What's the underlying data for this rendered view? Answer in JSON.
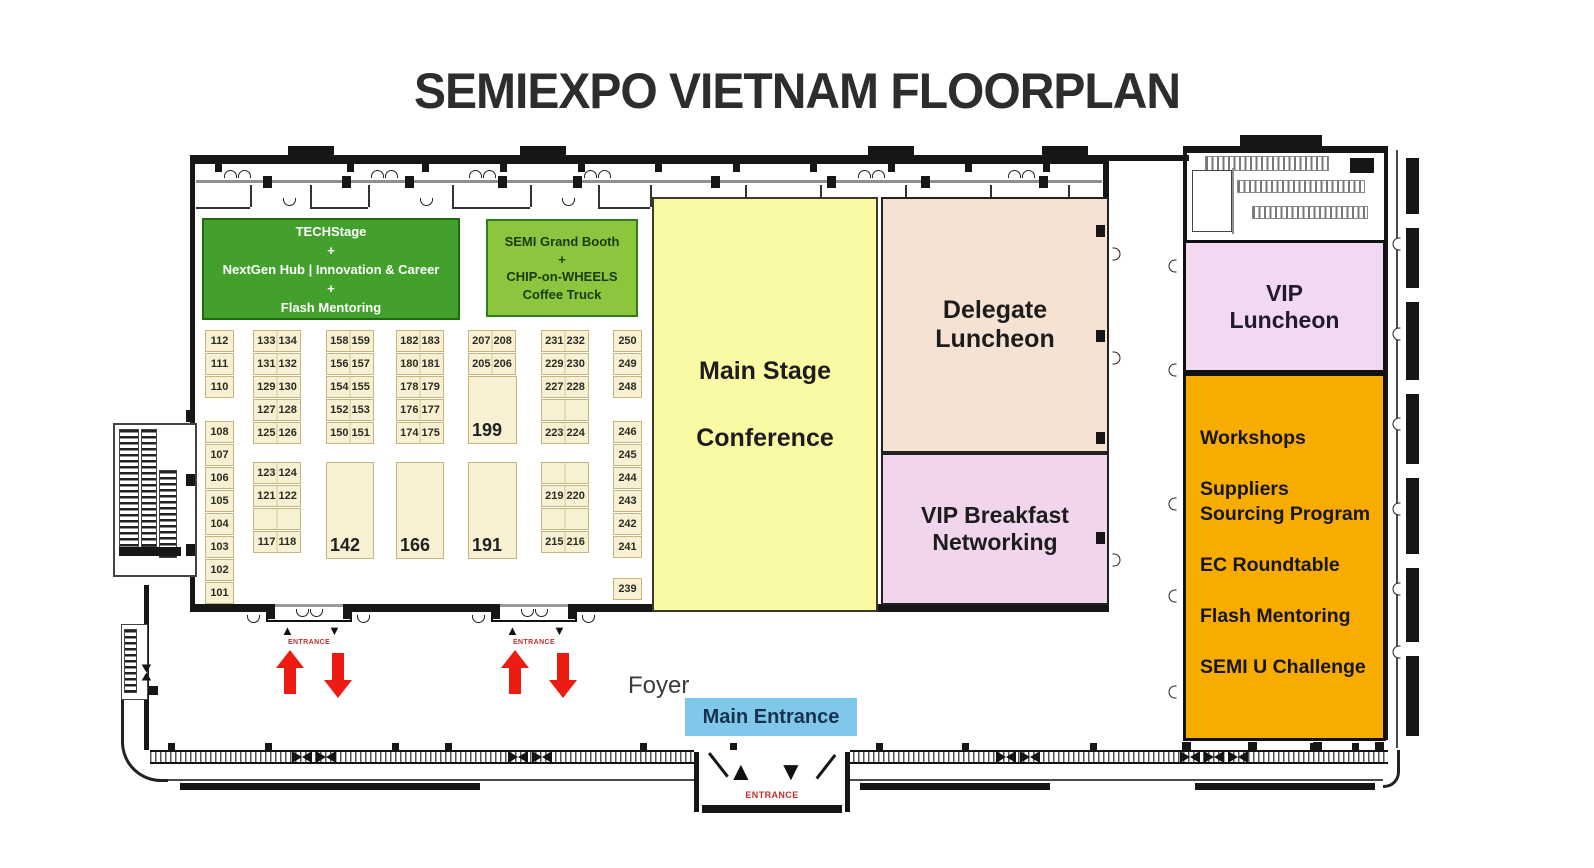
{
  "title": "SEMIEXPO VIETNAM FLOORPLAN",
  "colors": {
    "dark_green": "#43a02c",
    "light_green": "#8cc63f",
    "yellow": "#faf9a4",
    "peach": "#f6e2d2",
    "pink": "#f0d5ec",
    "vip_pink": "#f2d9f1",
    "orange": "#f9ac00",
    "blue": "#7fc8e9",
    "booth_fill": "#f8f0d3",
    "arrow_red": "#ec1c13",
    "entrance_red": "#c23030"
  },
  "zones": {
    "techstage": {
      "lines": [
        "TECHStage",
        "+",
        "NextGen Hub | Innovation & Career",
        "+",
        "Flash Mentoring"
      ]
    },
    "semi_grand_booth": {
      "lines": [
        "SEMI Grand Booth",
        "+",
        "CHIP-on-WHEELS",
        "Coffee Truck"
      ]
    },
    "main_stage": {
      "lines": [
        "Main Stage",
        "Conference"
      ]
    },
    "delegate_luncheon": {
      "label": "Delegate Luncheon"
    },
    "vip_breakfast": {
      "label": "VIP Breakfast Networking"
    },
    "vip_luncheon": {
      "label": "VIP Luncheon"
    },
    "programs": {
      "items": [
        "Workshops",
        "Suppliers Sourcing Program",
        "EC Roundtable",
        "Flash Mentoring",
        "SEMI U Challenge"
      ]
    }
  },
  "labels": {
    "foyer": "Foyer",
    "main_entrance": "Main Entrance",
    "entrance": "ENTRANCE"
  },
  "icons": {
    "up_arrow": "▲",
    "down_arrow": "▼"
  },
  "booths": {
    "colA_top": [
      "112",
      "111",
      "110"
    ],
    "colA_bottom": [
      "108",
      "107",
      "106",
      "105",
      "104",
      "103",
      "102",
      "101"
    ],
    "colB_top": [
      "133 134",
      "131 132",
      "129 130",
      "127 128",
      "125 126"
    ],
    "colB_bottom": [
      "123 124",
      "121 122",
      "",
      "117 118"
    ],
    "colC_top": [
      "158 159",
      "156 157",
      "154 155",
      "152 153",
      "150 151"
    ],
    "colC_big": "142",
    "colD_top": [
      "182 183",
      "180 181",
      "178 179",
      "176 177",
      "174 175"
    ],
    "colD_big": "166",
    "colE_top": [
      "207 208",
      "205 206"
    ],
    "colE_mid_big": "199",
    "colE_big": "191",
    "colF_top": [
      "231 232",
      "229 230",
      "227 228",
      "",
      "223 224"
    ],
    "colF_bottom": [
      "",
      "219 220",
      "",
      "215 216"
    ],
    "colG_top": [
      "250",
      "249",
      "248"
    ],
    "colG_mid": [
      "246",
      "245",
      "244",
      "243",
      "242",
      "241"
    ],
    "colG_low": [
      "239"
    ]
  }
}
